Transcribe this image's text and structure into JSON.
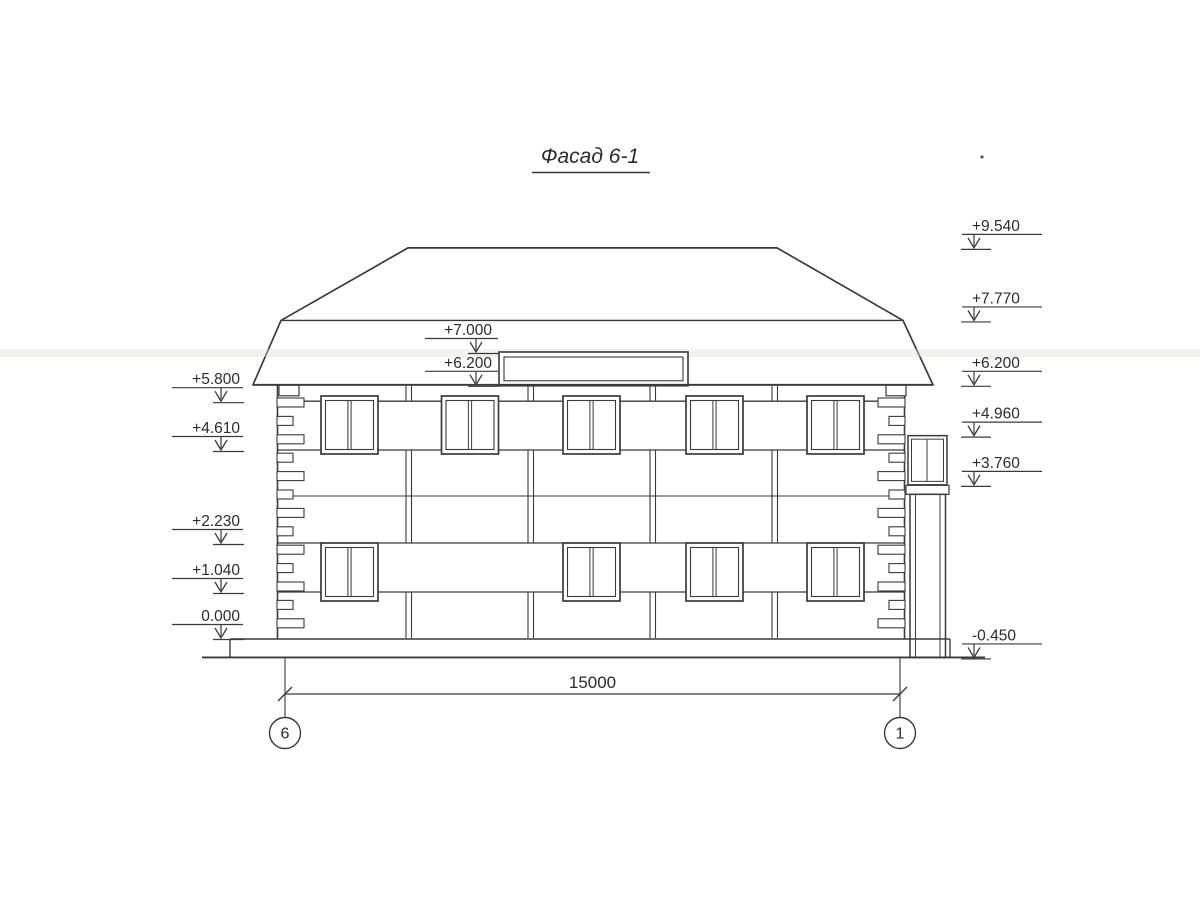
{
  "title": "Фасад 6-1",
  "colors": {
    "line": "#3a3a3a",
    "paper": "#ffffff",
    "scan_streak": "#d9d9d3"
  },
  "elevation_markers": {
    "left": [
      {
        "value": "+5.800"
      },
      {
        "value": "+4.610"
      },
      {
        "value": "+2.230"
      },
      {
        "value": "+1.040"
      },
      {
        "value": "0.000"
      }
    ],
    "middle": [
      {
        "value": "+7.000"
      },
      {
        "value": "+6.200"
      }
    ],
    "right": [
      {
        "value": "+9.540"
      },
      {
        "value": "+7.770"
      },
      {
        "value": "+6.200"
      },
      {
        "value": "+4.960"
      },
      {
        "value": "+3.760"
      },
      {
        "value": "-0.450"
      }
    ]
  },
  "dimension_label": "15000",
  "axis_bubbles": [
    {
      "label": "6"
    },
    {
      "label": "1"
    }
  ]
}
